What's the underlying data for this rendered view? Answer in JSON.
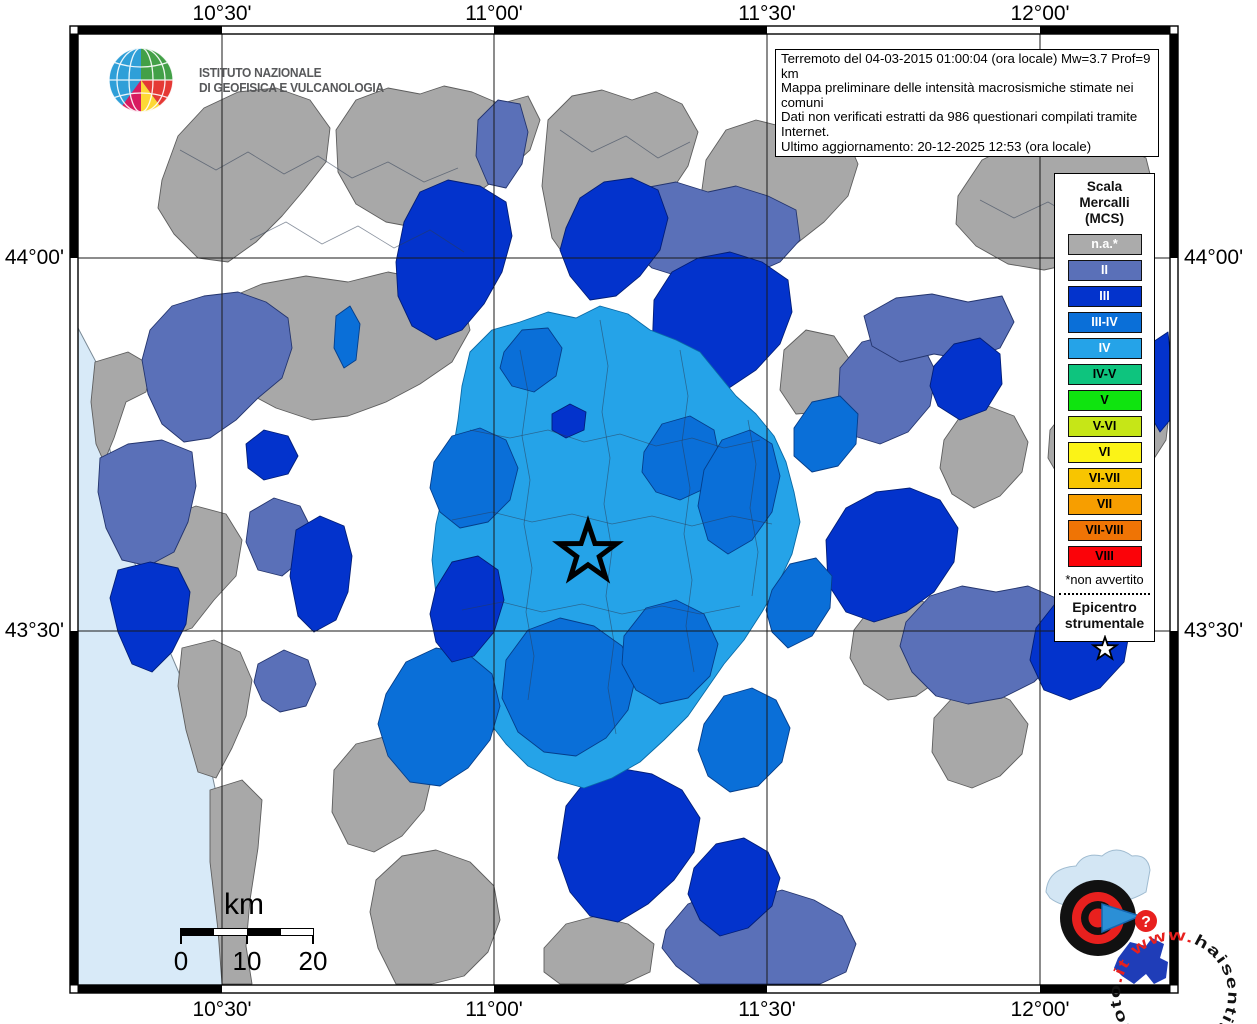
{
  "infobox": {
    "lines": [
      "Terremoto del 04-03-2015 01:00:04 (ora locale) Mw=3.7 Prof=9 km",
      "Mappa preliminare delle intensità macrosismiche stimate nei comuni",
      "Dati non verificati estratti da 986 questionari compilati tramite Internet.",
      "Ultimo aggiornamento: 20-12-2025 12:53 (ora locale)"
    ]
  },
  "ingv": {
    "line1": "ISTITUTO NAZIONALE",
    "line2": "DI GEOFISICA E VULCANOLOGIA"
  },
  "axis": {
    "top": [
      {
        "label": "10°30'",
        "x": 222
      },
      {
        "label": "11°00'",
        "x": 494
      },
      {
        "label": "11°30'",
        "x": 767
      },
      {
        "label": "12°00'",
        "x": 1040
      }
    ],
    "bottom": [
      {
        "label": "10°30'",
        "x": 222
      },
      {
        "label": "11°00'",
        "x": 494
      },
      {
        "label": "11°30'",
        "x": 767
      },
      {
        "label": "12°00'",
        "x": 1040
      }
    ],
    "left": [
      {
        "label": "44°00'",
        "y": 258
      },
      {
        "label": "43°30'",
        "y": 631
      }
    ],
    "right": [
      {
        "label": "44°00'",
        "y": 258
      },
      {
        "label": "43°30'",
        "y": 631
      }
    ]
  },
  "legend": {
    "title_lines": [
      "Scala",
      "Mercalli",
      "(MCS)"
    ],
    "items": [
      {
        "label": "n.a.*",
        "color": "#ABABAB",
        "text": "#FFFFFF"
      },
      {
        "label": "II",
        "color": "#5A70B8",
        "text": "#FFFFFF"
      },
      {
        "label": "III",
        "color": "#0333CC",
        "text": "#FFFFFF"
      },
      {
        "label": "III-IV",
        "color": "#0A6FD8",
        "text": "#FFFFFF"
      },
      {
        "label": "IV",
        "color": "#25A3E8",
        "text": "#FFFFFF"
      },
      {
        "label": "IV-V",
        "color": "#0EC47E",
        "text": "#000000"
      },
      {
        "label": "V",
        "color": "#0FE40F",
        "text": "#000000"
      },
      {
        "label": "V-VI",
        "color": "#C6E617",
        "text": "#000000"
      },
      {
        "label": "VI",
        "color": "#FBF317",
        "text": "#000000"
      },
      {
        "label": "VI-VII",
        "color": "#F8C500",
        "text": "#000000"
      },
      {
        "label": "VII",
        "color": "#F79E00",
        "text": "#000000"
      },
      {
        "label": "VII-VIII",
        "color": "#EF7405",
        "text": "#000000"
      },
      {
        "label": "VIII",
        "color": "#FB0309",
        "text": "#000000"
      }
    ],
    "footnote": "*non avvertito",
    "epicenter_line1": "Epicentro",
    "epicenter_line2": "strumentale"
  },
  "scalebar": {
    "unit": "km",
    "labels": [
      "0",
      "10",
      "20"
    ]
  },
  "watermark": {
    "pre": "www.",
    "mid": "haisentitoilterremoto",
    "post": ".it",
    "badge": "?"
  },
  "map_data": {
    "land_color": "#FFFFFF",
    "sea": {
      "color": "#D8EAF8",
      "points": "78,328 96,362 102,410 112,460 122,512 132,556 148,598 164,638 182,680 197,718 209,760 218,802 227,846 234,890 241,938 248,985 78,985"
    },
    "palette": {
      "g": "#A8A8A8",
      "s": "#5A70B8",
      "d": "#0333CC",
      "m": "#0A6FD8",
      "l": "#25A3E8"
    },
    "strokes": {
      "g": "#5E5E5E",
      "s": "#24356E",
      "d": "#021E78",
      "m": "#053E8A",
      "l": "#0A6AA6"
    },
    "gridlines": {
      "vx": [
        222,
        494,
        767,
        1040
      ],
      "hy": [
        258,
        631
      ]
    },
    "frame": {
      "x1": 70,
      "y1": 26,
      "x2": 1178,
      "y2": 993,
      "band": 8,
      "xcuts": [
        70,
        222,
        494,
        767,
        1040,
        1178
      ],
      "ycuts": [
        26,
        258,
        631,
        993
      ]
    },
    "epicenter": {
      "x": 588,
      "y": 553,
      "path": "M588,523 L594.9,543.5 L616.5,543.7 L599.2,556.6 L605.6,577.3 L588,564.8 L570.4,577.3 L576.8,556.6 L559.5,543.7 L581.1,543.5 Z"
    },
    "regions": [
      {
        "c": "g",
        "p": "162,180 178,136 204,108 238,92 276,88 310,100 330,128 326,162 304,190 282,216 256,242 228,262 198,258 174,234 158,208"
      },
      {
        "c": "g",
        "p": "336,130 356,100 388,88 420,94 444,86 472,92 500,104 528,96 540,120 530,150 506,172 478,192 450,214 418,228 386,222 356,204 338,172"
      },
      {
        "c": "g",
        "p": "548,120 572,96 602,90 632,100 656,92 682,104 698,132 688,166 668,196 648,224 624,252 598,274 572,266 552,238 542,186"
      },
      {
        "c": "g",
        "p": "706,160 726,130 756,120 788,128 818,122 846,136 858,164 848,196 824,222 796,244 766,262 734,266 712,244 700,204"
      },
      {
        "c": "g",
        "p": "958,196 982,160 1014,144 1050,140 1086,150 1118,144 1146,158 1154,190 1140,222 1112,244 1080,262 1044,270 1008,264 976,246 956,224"
      },
      {
        "c": "g",
        "p": "224,300 262,284 306,276 348,282 388,272 428,280 462,296 470,330 452,362 420,384 386,402 348,416 312,420 276,408 246,392 228,360 218,328"
      },
      {
        "c": "g",
        "p": "1050,430 1072,402 1100,390 1130,396 1156,388 1170,406 1166,440 1148,468 1122,488 1090,494 1062,482 1048,458"
      },
      {
        "c": "g",
        "p": "944,440 962,414 988,406 1014,416 1028,442 1022,472 1000,496 974,508 952,494 940,468"
      },
      {
        "c": "g",
        "p": "784,350 806,330 834,336 850,360 844,392 822,412 796,414 780,390"
      },
      {
        "c": "g",
        "p": "854,630 874,604 902,596 932,604 956,622 958,652 942,678 916,696 888,700 864,684 850,658"
      },
      {
        "c": "g",
        "p": "934,718 956,694 984,688 1010,700 1028,724 1022,754 1000,776 972,788 948,780 932,752"
      },
      {
        "c": "g",
        "p": "544,948 566,924 596,916 628,924 654,944 650,972 624,984 560,984 544,972"
      },
      {
        "c": "g",
        "p": "334,770 356,744 388,736 418,748 432,776 424,810 402,836 374,852 348,844 332,812"
      },
      {
        "c": "g",
        "p": "376,880 402,856 436,850 470,862 494,886 500,920 488,952 464,976 432,984 396,984 378,948 370,912"
      },
      {
        "c": "g",
        "p": "95,362 128,352 152,366 146,392 126,402 114,438 104,462 96,444 91,402"
      },
      {
        "c": "g",
        "p": "160,520 196,506 226,514 242,540 236,576 214,600 192,628 170,636 158,596 152,556"
      },
      {
        "c": "g",
        "p": "182,648 214,640 240,652 252,680 246,716 232,748 216,778 198,772 186,730 178,686"
      },
      {
        "c": "g",
        "p": "210,790 242,780 262,800 258,848 250,900 246,946 252,984 222,984 218,930 210,862"
      },
      {
        "c": "s",
        "p": "150,330 172,306 204,296 238,292 266,302 288,318 292,348 282,378 258,398 236,420 210,438 184,442 162,424 148,394 142,360"
      },
      {
        "c": "s",
        "p": "478,120 498,100 520,104 528,132 522,164 506,188 488,184 476,156"
      },
      {
        "c": "s",
        "p": "620,210 644,188 676,182 708,192 736,186 768,196 796,210 800,240 780,262 748,276 714,270 684,278 652,268 628,246 616,228"
      },
      {
        "c": "s",
        "p": "840,368 862,342 892,334 922,344 936,372 930,406 908,432 880,444 854,436 838,408"
      },
      {
        "c": "s",
        "p": "864,316 896,298 932,294 968,302 1002,296 1014,322 1000,348 968,360 934,354 900,362 872,346"
      },
      {
        "c": "s",
        "p": "906,622 930,596 962,586 996,592 1028,586 1056,598 1068,626 1058,658 1034,682 1002,698 968,704 936,696 912,672 900,646"
      },
      {
        "c": "s",
        "p": "666,930 688,904 718,892 752,898 782,890 814,900 842,916 856,944 846,972 820,984 700,984 676,966 662,948"
      },
      {
        "c": "s",
        "p": "100,458 128,444 162,440 192,452 196,486 188,522 174,552 148,566 122,560 106,528 98,492"
      },
      {
        "c": "s",
        "p": "250,512 274,498 300,506 312,530 304,558 282,576 258,570 246,542"
      },
      {
        "c": "s",
        "p": "258,664 284,650 308,660 316,684 306,706 280,712 262,700 254,682"
      },
      {
        "c": "d",
        "p": "396,262 404,222 420,192 448,180 480,186 506,202 512,236 502,272 484,304 462,330 436,340 412,326 398,296"
      },
      {
        "c": "d",
        "p": "566,228 580,198 604,182 632,178 658,190 668,218 660,250 640,276 616,296 590,300 570,276 560,250"
      },
      {
        "c": "d",
        "p": "654,300 672,272 698,258 730,252 762,262 788,280 792,312 780,344 756,370 726,390 694,398 668,384 652,352"
      },
      {
        "c": "d",
        "p": "118,570 150,562 178,568 190,592 186,624 172,652 152,672 132,664 118,632 110,598"
      },
      {
        "c": "d",
        "p": "246,444 264,430 288,436 298,456 288,474 264,480 248,468"
      },
      {
        "c": "d",
        "p": "296,530 320,516 344,526 352,556 348,592 336,620 314,632 298,616 290,576"
      },
      {
        "c": "d",
        "p": "826,540 846,508 876,492 910,488 940,500 958,528 954,562 934,592 906,612 874,622 846,612 828,584"
      },
      {
        "c": "d",
        "p": "1036,628 1058,600 1088,590 1116,600 1130,628 1124,662 1100,688 1070,700 1044,690 1030,660"
      },
      {
        "c": "d",
        "p": "1150,344 1168,332 1170,352 1170,420 1160,432 1146,408 1142,372"
      },
      {
        "c": "d",
        "p": "934,366 954,344 980,338 1000,354 1002,384 986,410 960,420 938,406 930,386"
      },
      {
        "c": "d",
        "p": "566,806 588,778 618,768 652,774 682,790 700,818 694,852 674,880 648,904 618,922 590,916 570,892 558,858"
      },
      {
        "c": "d",
        "p": "694,868 716,844 744,838 768,852 780,878 772,906 748,928 720,936 700,920 688,894"
      },
      {
        "c": "l",
        "p": "470,352 492,330 520,322 548,312 576,318 600,306 628,314 650,330 676,340 700,352 718,374 736,396 756,414 774,436 786,462 794,492 800,522 792,554 778,584 762,612 744,640 724,664 706,690 688,716 664,740 640,762 612,778 584,788 556,780 528,766 506,744 486,718 470,690 456,660 444,628 436,594 432,560 436,524 444,490 452,456 458,420 462,386"
      },
      {
        "c": "m",
        "p": "504,352 522,330 548,328 562,348 556,376 534,392 512,386 500,368"
      },
      {
        "c": "m",
        "p": "644,452 662,424 690,416 714,430 720,460 706,488 680,500 656,492 642,472"
      },
      {
        "c": "m",
        "p": "704,470 722,440 750,430 772,444 780,476 772,512 752,540 728,554 708,540 698,506"
      },
      {
        "c": "m",
        "p": "434,462 452,436 480,428 506,440 518,468 510,500 488,522 460,528 440,512 430,488"
      },
      {
        "c": "m",
        "p": "506,660 528,630 560,618 594,626 622,646 636,676 628,710 606,738 576,756 544,752 518,732 502,698"
      },
      {
        "c": "m",
        "p": "624,636 646,608 676,600 704,614 718,644 710,676 688,698 660,704 636,690 622,664"
      },
      {
        "c": "m",
        "p": "386,694 406,662 436,648 468,654 492,674 500,706 490,740 468,768 440,786 410,782 388,756 378,724"
      },
      {
        "c": "m",
        "p": "704,724 724,696 752,688 776,700 790,728 782,762 758,786 730,792 708,776 698,750"
      },
      {
        "c": "m",
        "p": "772,590 790,564 816,558 832,576 830,608 812,636 788,648 772,632 766,610"
      },
      {
        "c": "m",
        "p": "336,316 350,306 360,324 356,360 344,368 334,348"
      },
      {
        "c": "m",
        "p": "794,428 812,402 840,396 858,414 856,444 838,466 812,472 794,456"
      },
      {
        "c": "d",
        "p": "436,588 452,562 478,556 498,570 504,600 494,632 474,656 452,662 436,642 430,614"
      },
      {
        "c": "d",
        "p": "552,414 570,404 586,412 584,430 566,438 552,430"
      }
    ],
    "borders": [
      "470,430 510,438 548,430 584,442 620,434 656,446 692,438 724,448 760,440",
      "452,520 492,512 532,522 572,514 612,524 652,516 692,526 732,516 772,524",
      "462,610 502,602 542,612 582,604 622,614 662,606 700,614 740,606",
      "520,350 528,392 522,436 530,480 524,524 532,568 526,612 534,656 528,700",
      "600,320 608,366 602,412 610,458 604,504 612,550 606,596 614,642 608,688 616,734",
      "680,350 688,396 682,442 690,488 684,534 692,580 686,626 694,672",
      "748,420 756,464 750,508 758,552 752,596",
      "180,150 216,170 248,152 284,174 318,156 352,178 388,162 424,182 458,168",
      "250,240 286,222 322,244 358,226 394,248 430,230 464,252",
      "560,130 592,152 626,136 658,158 690,142",
      "980,200 1014,218 1048,202 1082,222 1116,206 1146,224"
    ]
  }
}
